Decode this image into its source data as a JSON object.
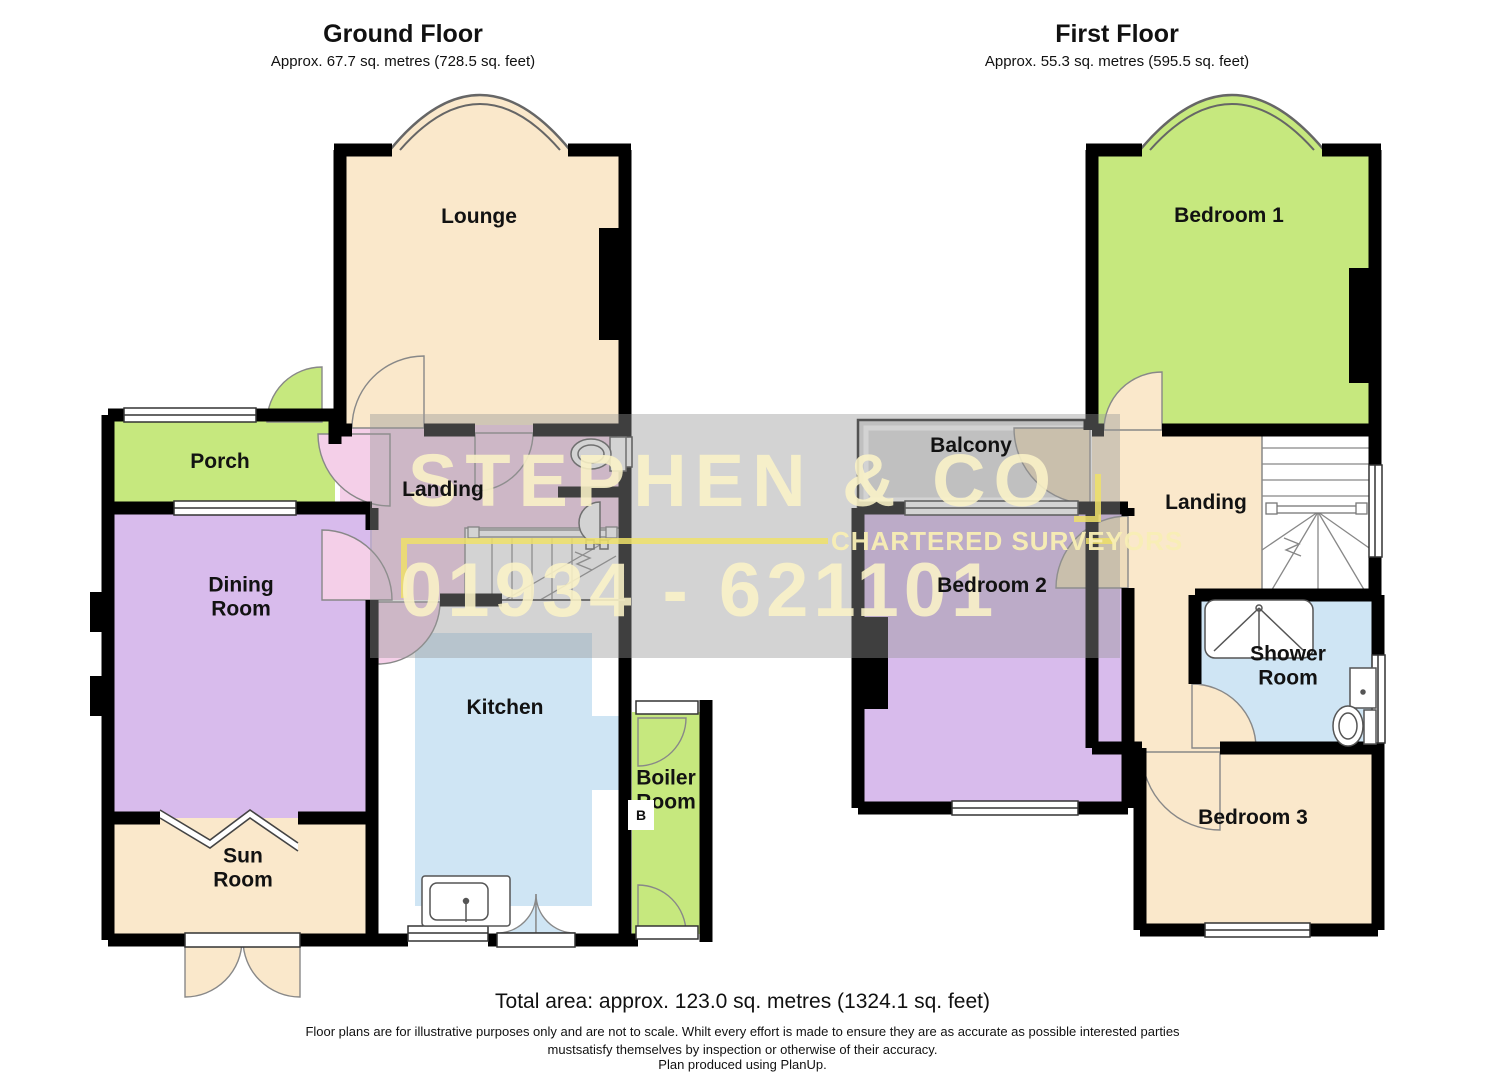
{
  "ground_floor": {
    "title": "Ground Floor",
    "subtitle": "Approx. 67.7 sq. metres (728.5 sq. feet)",
    "rooms": {
      "lounge": "Lounge",
      "porch": "Porch",
      "landing": "Landing",
      "dining_room": "Dining Room",
      "kitchen": "Kitchen",
      "sun_room": "Sun Room",
      "boiler_room": "Boiler Room",
      "boiler_marker": "B"
    }
  },
  "first_floor": {
    "title": "First Floor",
    "subtitle": "Approx. 55.3 sq. metres (595.5 sq. feet)",
    "rooms": {
      "bedroom1": "Bedroom 1",
      "balcony": "Balcony",
      "landing": "Landing",
      "bedroom2": "Bedroom 2",
      "shower_room": "Shower Room",
      "bedroom3": "Bedroom 3"
    }
  },
  "watermark": {
    "line1": "STEPHEN & CO",
    "line2": "CHARTERED SURVEYORS",
    "line3": "01934 - 621101"
  },
  "footer": {
    "total_area": "Total area: approx. 123.0 sq. metres (1324.1 sq. feet)",
    "disclaimer1": "Floor plans are for illustrative purposes only and are not to scale. Whilt every effort is made to ensure they are as accurate as possible interested parties",
    "disclaimer2": "mustsatisfy themselves by inspection or otherwise of their accuracy.",
    "disclaimer3": "Plan produced using PlanUp."
  },
  "colors": {
    "cream": "#FAE8CB",
    "green": "#C6E87E",
    "purple": "#D8BBEC",
    "pink": "#F4CFE8",
    "blue": "#CFE5F4",
    "balcony_gray": "#DEDEDE",
    "wall": "#000000",
    "watermark_band": "rgba(150,150,150,0.42)",
    "watermark_accent": "#EFE069"
  }
}
